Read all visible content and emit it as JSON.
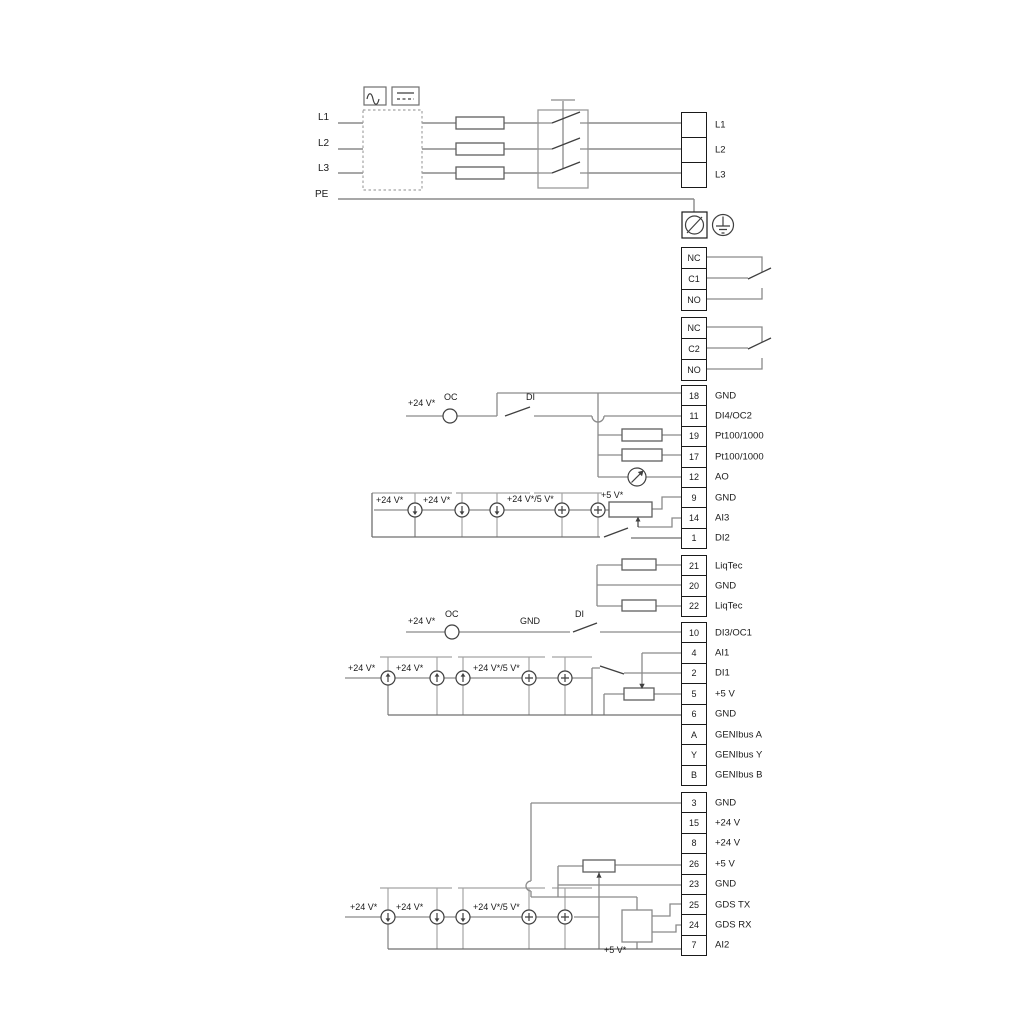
{
  "diagram": {
    "power_inputs": [
      "L1",
      "L2",
      "L3",
      "PE"
    ],
    "power_terminals": [
      {
        "label": "L1"
      },
      {
        "label": "L2"
      },
      {
        "label": "L3"
      }
    ],
    "relay1": [
      "NC",
      "C1",
      "NO"
    ],
    "relay2": [
      "NC",
      "C2",
      "NO"
    ],
    "io_block_1": [
      {
        "num": "18",
        "label": "GND"
      },
      {
        "num": "11",
        "label": "DI4/OC2"
      },
      {
        "num": "19",
        "label": "Pt100/1000"
      },
      {
        "num": "17",
        "label": "Pt100/1000"
      },
      {
        "num": "12",
        "label": "AO"
      },
      {
        "num": "9",
        "label": "GND"
      },
      {
        "num": "14",
        "label": "AI3"
      },
      {
        "num": "1",
        "label": "DI2"
      }
    ],
    "liqtec_block": [
      {
        "num": "21",
        "label": "LiqTec"
      },
      {
        "num": "20",
        "label": "GND"
      },
      {
        "num": "22",
        "label": "LiqTec"
      }
    ],
    "io_block_2": [
      {
        "num": "10",
        "label": "DI3/OC1"
      },
      {
        "num": "4",
        "label": "AI1"
      },
      {
        "num": "2",
        "label": "DI1"
      },
      {
        "num": "5",
        "label": "+5 V"
      },
      {
        "num": "6",
        "label": "GND"
      },
      {
        "num": "A",
        "label": "GENIbus A"
      },
      {
        "num": "Y",
        "label": "GENIbus Y"
      },
      {
        "num": "B",
        "label": "GENIbus B"
      }
    ],
    "io_block_3": [
      {
        "num": "3",
        "label": "GND"
      },
      {
        "num": "15",
        "label": "+24 V"
      },
      {
        "num": "8",
        "label": "+24 V"
      },
      {
        "num": "26",
        "label": "+5 V"
      },
      {
        "num": "23",
        "label": "GND"
      },
      {
        "num": "25",
        "label": "GDS TX"
      },
      {
        "num": "24",
        "label": "GDS RX"
      },
      {
        "num": "7",
        "label": "AI2"
      }
    ],
    "circuit_labels": {
      "plus24": "+24 V*",
      "plus24_5": "+24 V*/5 V*",
      "plus5": "+5 V*",
      "oc": "OC",
      "di": "DI",
      "gnd": "GND"
    },
    "icons": {
      "ac_symbol": "ac-wave-icon",
      "dc_symbol": "dc-lines-icon",
      "ground_terminal": "ground-terminal-icon",
      "earth_ground": "earth-ground-icon",
      "current_sink": "arrow-down-circle-icon",
      "current_source": "arrow-up-circle-icon",
      "voltage_source": "plus-circle-icon",
      "analog_meter": "meter-arrow-circle-icon"
    },
    "wire_colors": {
      "wire_gray": "#8a8a8a",
      "symbol_dark": "#3f3f3f",
      "border_black": "#1a1a1a"
    }
  }
}
